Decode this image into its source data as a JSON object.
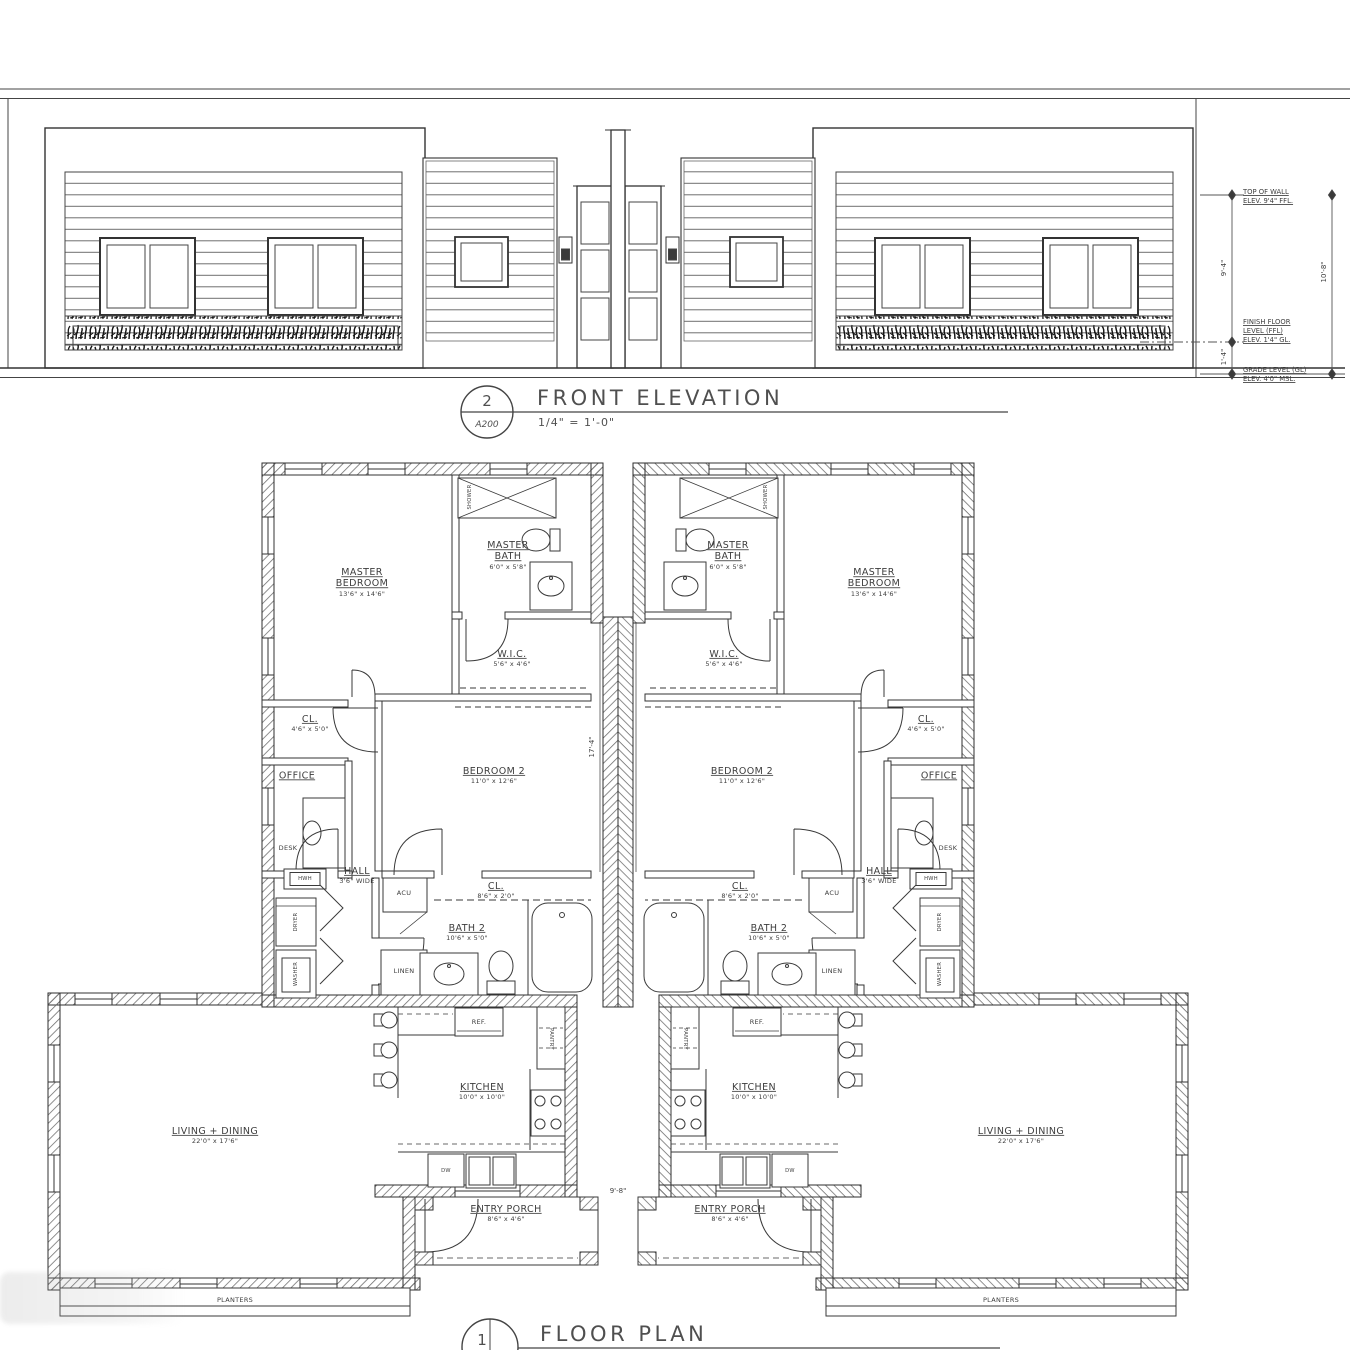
{
  "elevation": {
    "title": {
      "number": "2",
      "sheet": "A200",
      "name": "FRONT ELEVATION",
      "scale": "1/4\" = 1'-0\""
    },
    "annotations": {
      "top_of_wall": [
        "TOP OF WALL",
        "ELEV. 9'4\" FFL."
      ],
      "finish_floor": [
        "FINISH FLOOR",
        "LEVEL (FFL)",
        "ELEV. 1'4\" GL."
      ],
      "grade_level": [
        "GRADE LEVEL (GL)",
        "ELEV. 4'0\" MSL."
      ],
      "dim_wall_height": "9'-4\"",
      "dim_total_height": "10'-8\"",
      "dim_plinth": "1'-4\""
    }
  },
  "floor_plan": {
    "title": {
      "number": "1",
      "name": "FLOOR PLAN"
    },
    "rooms": {
      "master_bedroom": {
        "name": "MASTER BEDROOM",
        "dims": "13'6\" x 14'6\""
      },
      "master_bath": {
        "name": "MASTER BATH",
        "dims": "6'0\" x 5'8\""
      },
      "wic": {
        "name": "W.I.C.",
        "dims": "5'6\" x 4'6\""
      },
      "closet_front": {
        "name": "CL.",
        "dims": "4'6\" x 5'0\""
      },
      "office": {
        "name": "OFFICE"
      },
      "bedroom2": {
        "name": "BEDROOM 2",
        "dims": "11'0\" x 12'6\""
      },
      "hall": {
        "name": "HALL",
        "dims": "3'6\" WIDE"
      },
      "closet_hall": {
        "name": "CL.",
        "dims": "8'6\" x 2'0\""
      },
      "bath2": {
        "name": "BATH 2",
        "dims": "10'6\" x 5'0\""
      },
      "kitchen": {
        "name": "KITCHEN",
        "dims": "10'0\" x 10'0\""
      },
      "living_dining": {
        "name": "LIVING + DINING",
        "dims": "22'0\" x 17'6\""
      },
      "entry_porch": {
        "name": "ENTRY PORCH",
        "dims": "8'6\" x 4'6\""
      }
    },
    "fixtures": {
      "shower": "SHOWER",
      "desk": "DESK",
      "acu": "ACU",
      "linen": "LINEN",
      "hwh": "HWH",
      "dryer": "DRYER",
      "washer": "WASHER",
      "ref": "REF.",
      "pantry": "PANTRY",
      "dw": "DW",
      "planters": "PLANTERS"
    },
    "dimensions": {
      "porch_gap": "9'-8\"",
      "center_depth": "17'-4\""
    }
  }
}
